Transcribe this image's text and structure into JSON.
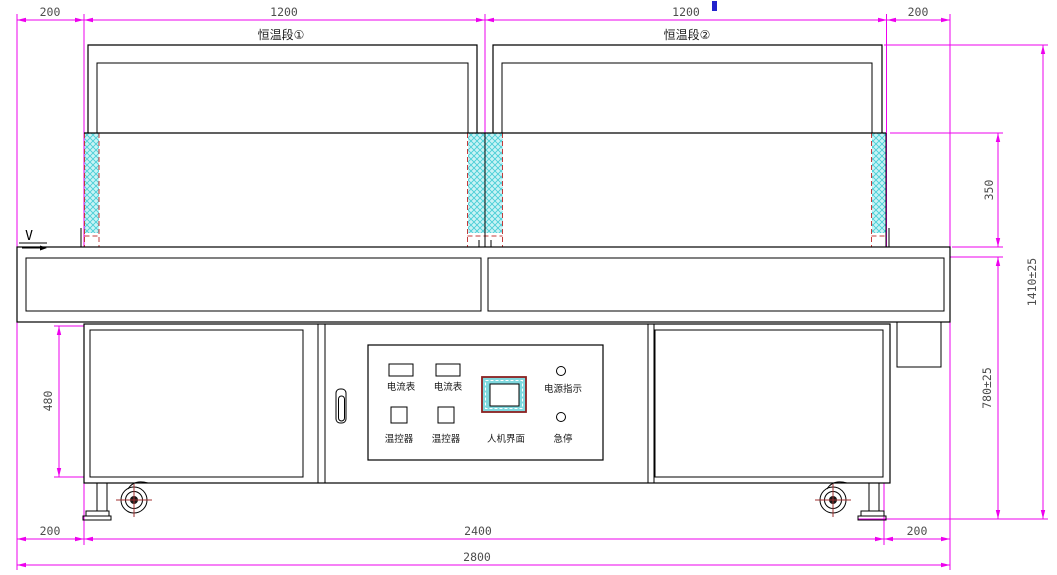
{
  "drawing": {
    "section_labels": [
      "恒温段①",
      "恒温段②"
    ],
    "direction_label": "V",
    "dimensions": {
      "top": [
        "200",
        "1200",
        "1200",
        "200"
      ],
      "bottom_left": "200",
      "bottom_2400": "2400",
      "bottom_right": "200",
      "bottom_2800": "2800",
      "hood_height": "350",
      "height_overall": "1410±25",
      "table_height": "780±25",
      "cabinet_height": "480"
    },
    "control_panel": {
      "ammeters": [
        "电流表",
        "电流表"
      ],
      "temp_controllers": [
        "温控器",
        "温控器"
      ],
      "hmi_label": "人机界面",
      "power_indicator_label": "电源指示",
      "estop_label": "急停"
    },
    "colors": {
      "line": "#000000",
      "dimension": "#EE00EE",
      "dim_text": "#4D4D4D",
      "hatch_fill": "#C9F3F5",
      "hatch_line": "#49CED6",
      "dashed_red": "#C23B3B",
      "wheel_cross": "#A03030",
      "hmi_border": "#8B2020",
      "hmi_screen": "#7FD8DE",
      "cursor_blue": "#2222CC"
    }
  }
}
